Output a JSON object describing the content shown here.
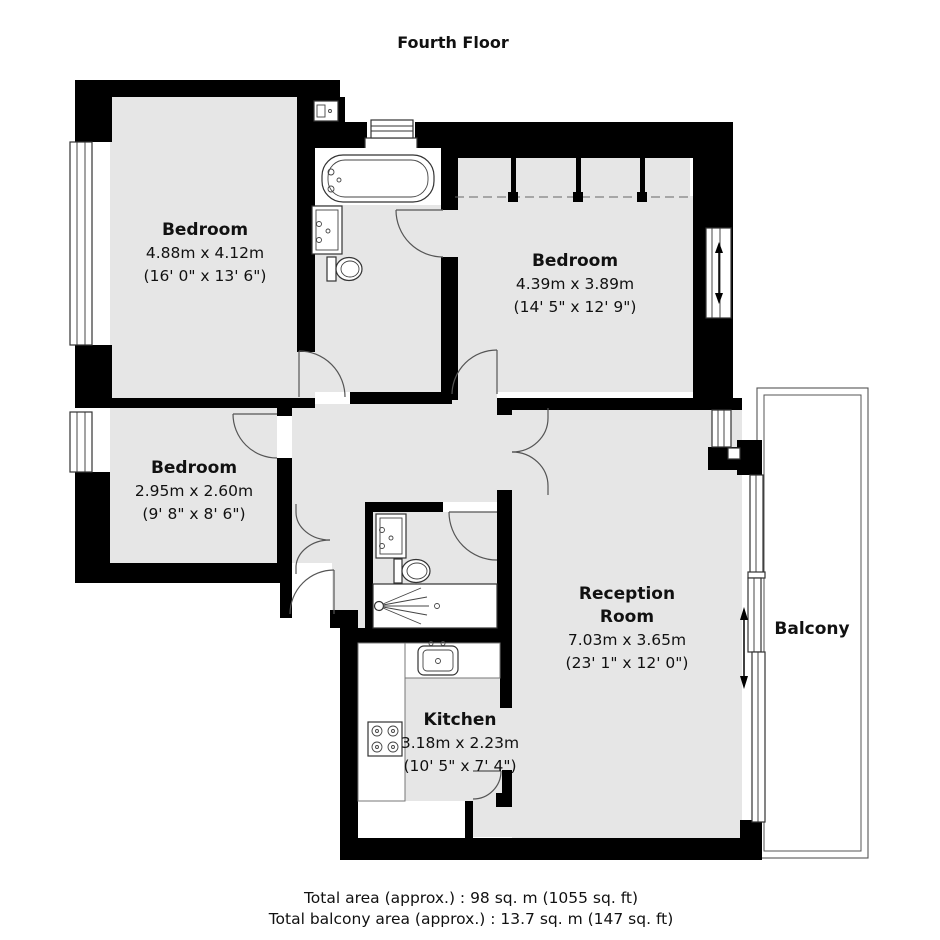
{
  "title": "Fourth Floor",
  "rooms": {
    "bedroom1": {
      "name": "Bedroom",
      "metric": "4.88m x 4.12m",
      "imperial": "(16' 0\" x 13' 6\")"
    },
    "bedroom2": {
      "name": "Bedroom",
      "metric": "4.39m x 3.89m",
      "imperial": "(14' 5\" x 12' 9\")"
    },
    "bedroom3": {
      "name": "Bedroom",
      "metric": "2.95m x 2.60m",
      "imperial": "(9' 8\" x 8' 6\")"
    },
    "reception": {
      "name_line1": "Reception",
      "name_line2": "Room",
      "metric": "7.03m x 3.65m",
      "imperial": "(23' 1\" x 12' 0\")"
    },
    "kitchen": {
      "name": "Kitchen",
      "metric": "3.18m x 2.23m",
      "imperial": "(10' 5\" x 7' 4\")"
    },
    "balcony": {
      "name": "Balcony"
    }
  },
  "footer": {
    "total_area": "Total area (approx.) : 98 sq. m (1055 sq. ft)",
    "total_balcony_area": "Total balcony area (approx.) : 13.7 sq. m (147 sq. ft)"
  },
  "colors": {
    "wall": "#000000",
    "floor": "#e6e6e6",
    "text": "#111111"
  }
}
